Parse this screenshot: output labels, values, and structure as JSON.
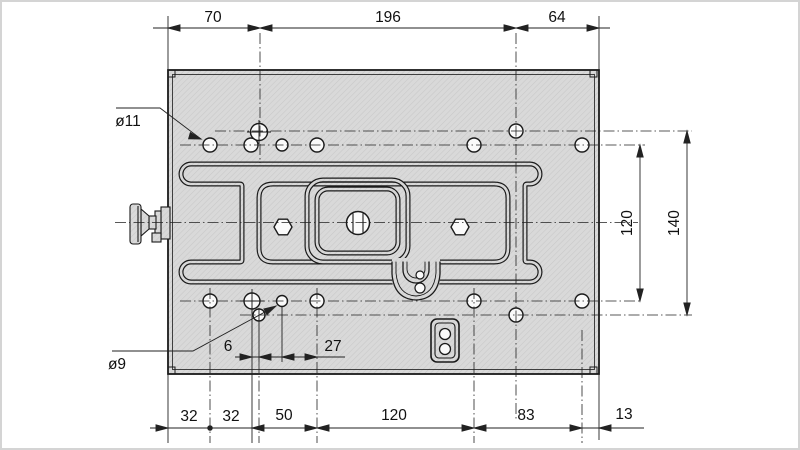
{
  "meta": {
    "title": "Mounting plate dimensional drawing (top view)",
    "drawing_type": "technical-drawing"
  },
  "callouts": {
    "large_hole": "ø11",
    "small_hole": "ø9"
  },
  "dims": {
    "top": {
      "d70": "70",
      "d196": "196",
      "d64": "64"
    },
    "bottom": {
      "d32a": "32",
      "d32b": "32",
      "d50": "50",
      "d120": "120",
      "d83": "83",
      "d13": "13"
    },
    "right": {
      "d120": "120",
      "d140": "140"
    },
    "inner": {
      "d6": "6",
      "d27": "27"
    }
  },
  "colors": {
    "plate_fill": "#d9d9d9",
    "hatch_line": "#c8c8c8",
    "outline": "#1a1a1a",
    "hole_fill": "#fafafa",
    "background": "#ffffff",
    "frame": "#d4d4d4"
  }
}
